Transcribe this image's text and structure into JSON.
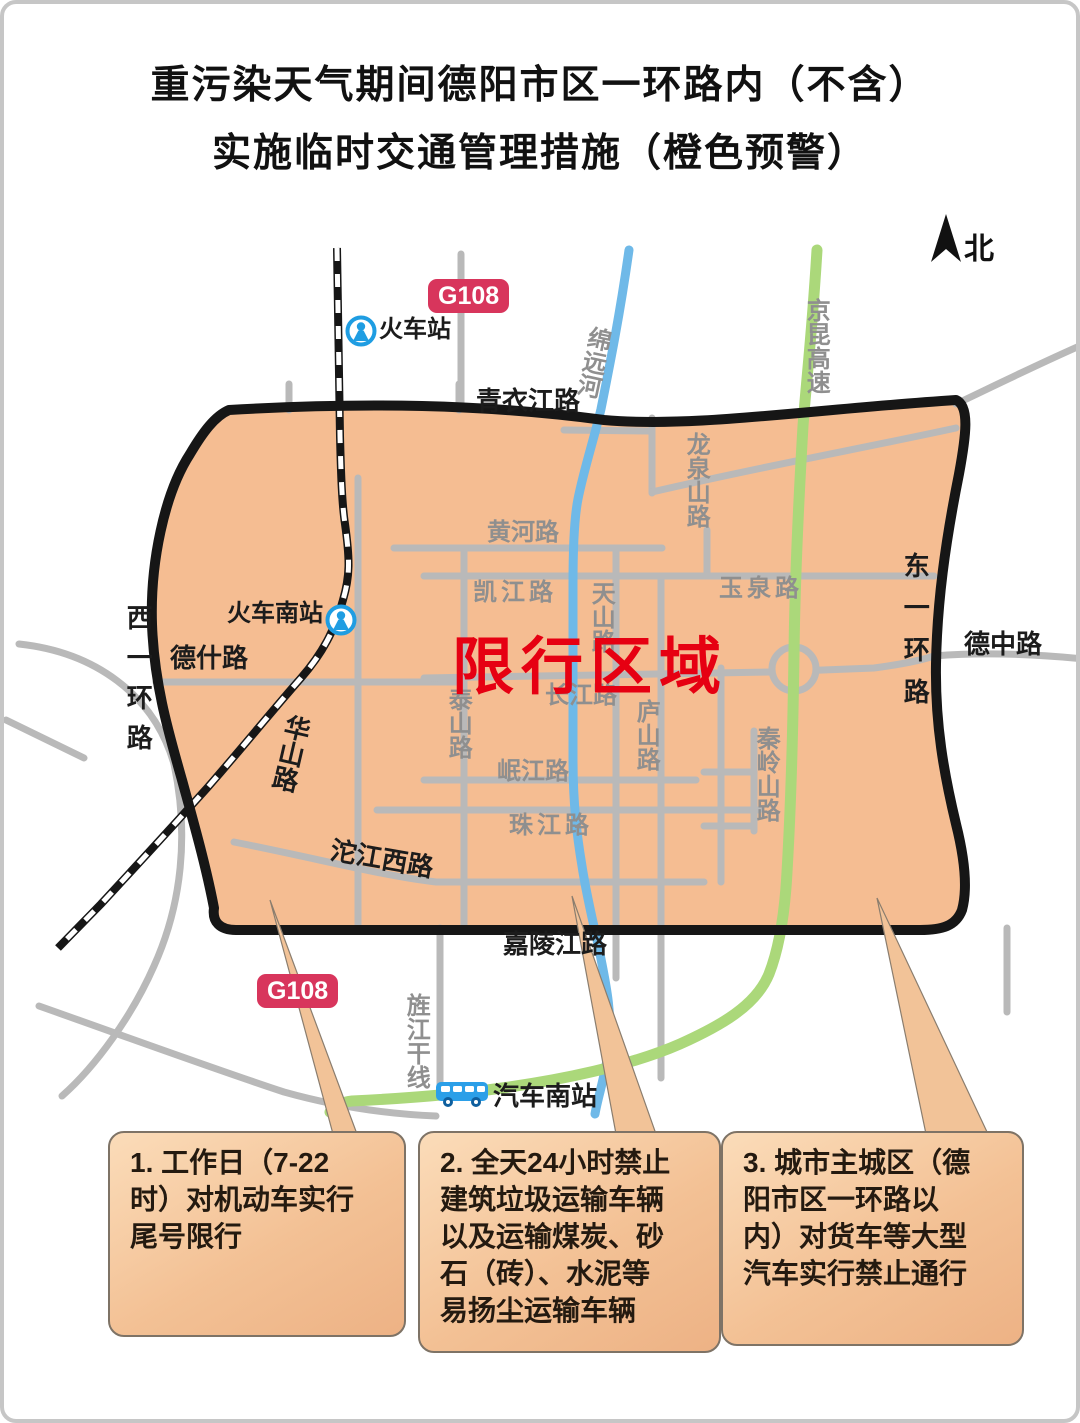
{
  "title": {
    "line1": "重污染天气期间德阳市区一环路内（不含）",
    "line2": "实施临时交通管理措施（橙色预警）"
  },
  "map": {
    "north": "北",
    "zone_label": "限行区域",
    "badge_g108": "G108",
    "stations": {
      "train_station": "火车站",
      "train_south_station": "火车南站",
      "bus_south_station": "汽车南站"
    },
    "labels": {
      "qingyijiang": "青衣江路",
      "jialingjiang": "嘉陵江路",
      "dezhong": "德中路",
      "deshi": "德什路",
      "tuojiangxi": "沱江西路",
      "huashan": "华山路",
      "xiyihuan": "西一环路",
      "dongyihuan": "东一环路",
      "huanghe": "黄河路",
      "kaijiang": "凯江路",
      "tianshan": "天山路",
      "yuquan": "玉泉路",
      "changjiang": "长江路",
      "lushan": "庐山路",
      "taishan": "泰山路",
      "minjiang": "岷江路",
      "zhujiang": "珠江路",
      "qinlingshan": "秦岭山路",
      "longquanshan": "龙泉山路",
      "jingjiangganxian": "旌江干线",
      "jingkun": "京昆高速",
      "mianyuanhe": "绵远河"
    },
    "colors": {
      "zone_fill": "#f5bd92",
      "zone_border": "#161616",
      "road_gray": "#b9b9b9",
      "river_blue": "#6fb9e8",
      "highway_green": "#abd87a",
      "restricted_red": "#e60012",
      "badge_red": "#d8355c",
      "station_blue": "#1f9de2"
    }
  },
  "callouts": [
    {
      "text": "1. 工作日（7-22\n时）对机动车实行\n尾号限行"
    },
    {
      "text": "2. 全天24小时禁止\n建筑垃圾运输车辆\n以及运输煤炭、砂\n石（砖）、水泥等\n易扬尘运输车辆"
    },
    {
      "text": "3. 城市主城区（德\n阳市区一环路以\n内）对货车等大型\n汽车实行禁止通行"
    }
  ]
}
